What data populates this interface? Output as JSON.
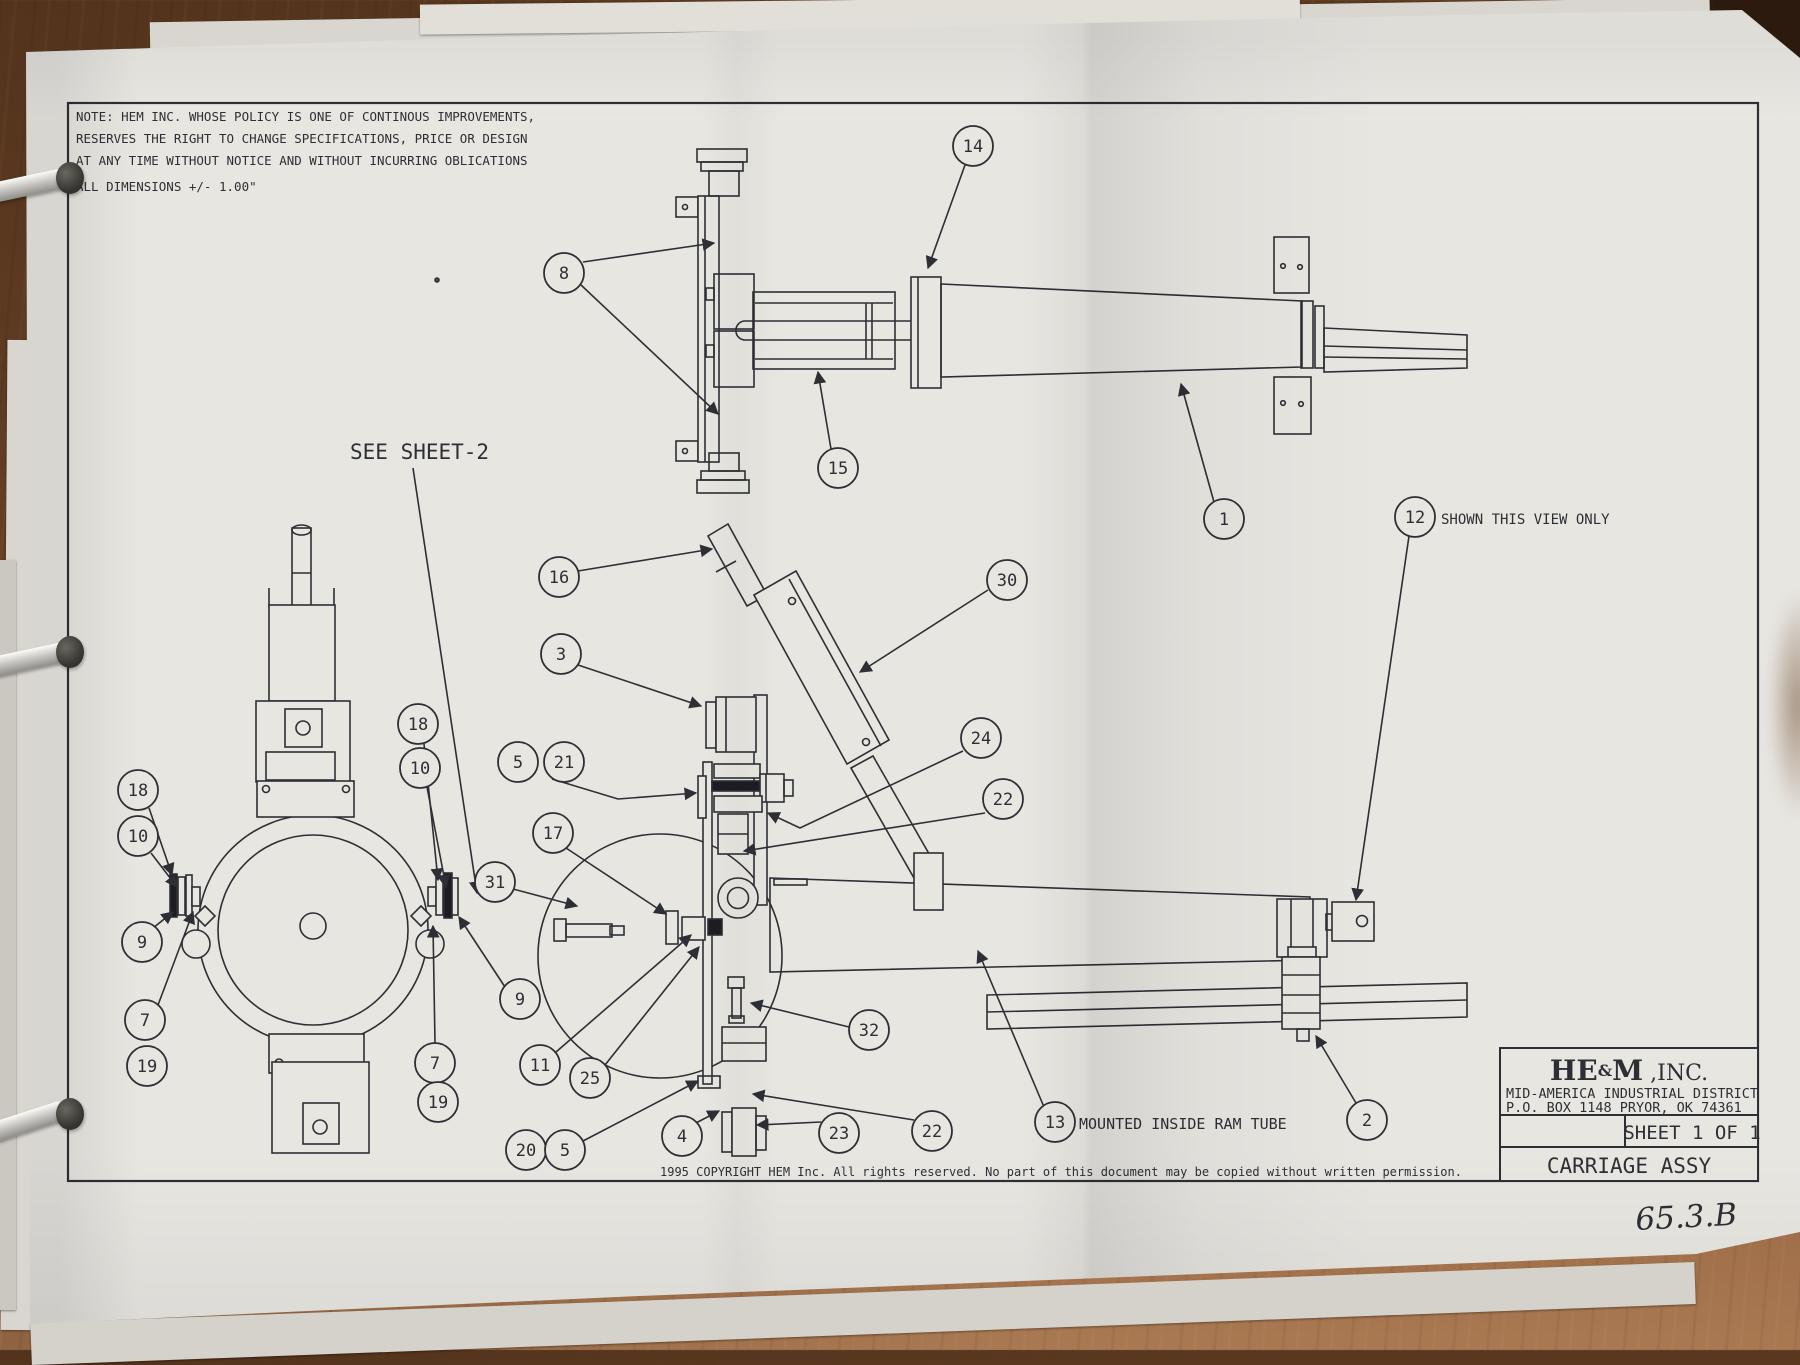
{
  "note": {
    "lines": [
      "NOTE: HEM INC. WHOSE POLICY IS ONE OF CONTINOUS IMPROVEMENTS,",
      "RESERVES THE RIGHT TO CHANGE SPECIFICATIONS, PRICE OR DESIGN",
      "AT ANY TIME WITHOUT NOTICE AND WITHOUT INCURRING OBLICATIONS",
      "ALL DIMENSIONS +/- 1.00\""
    ]
  },
  "labels": {
    "see_sheet": "SEE SHEET-2",
    "shown_view": "SHOWN THIS VIEW ONLY",
    "mounted": "MOUNTED INSIDE RAM TUBE"
  },
  "copyright": "1995 COPYRIGHT   HEM Inc.   All rights reserved.   No part of this document may be copied without written permission.",
  "title_block": {
    "logo_he": "HE",
    "logo_amp": "&",
    "logo_m": "M",
    "logo_suffix": " ,INC.",
    "address1": "MID-AMERICA INDUSTRIAL DISTRICT",
    "address2": "P.O. BOX 1148    PRYOR, OK   74361",
    "sheet": "SHEET 1 OF 1",
    "title": "CARRIAGE ASSY"
  },
  "handwritten": "65.3.B",
  "colors": {
    "paper": "#e8e6e1",
    "ink": "#2e2f35",
    "wood_dark": "#5a3820",
    "wood_light": "#a97952"
  },
  "balloons": [
    {
      "id": "8",
      "label": "8",
      "x": 564,
      "y": 273,
      "leaders": [
        [
          [
            583,
            262
          ],
          [
            714,
            243
          ]
        ],
        [
          [
            581,
            285
          ],
          [
            718,
            414
          ]
        ]
      ]
    },
    {
      "id": "14",
      "label": "14",
      "x": 973,
      "y": 146,
      "leaders": [
        [
          [
            965,
            165
          ],
          [
            928,
            268
          ]
        ]
      ]
    },
    {
      "id": "15",
      "label": "15",
      "x": 838,
      "y": 468,
      "leaders": [
        [
          [
            831,
            449
          ],
          [
            818,
            372
          ]
        ]
      ]
    },
    {
      "id": "1",
      "label": "1",
      "x": 1224,
      "y": 519,
      "leaders": [
        [
          [
            1214,
            502
          ],
          [
            1181,
            384
          ]
        ]
      ]
    },
    {
      "id": "12",
      "label": "12",
      "x": 1415,
      "y": 517,
      "leaders": [
        [
          [
            1409,
            536
          ],
          [
            1356,
            900
          ]
        ]
      ]
    },
    {
      "id": "16",
      "label": "16",
      "x": 559,
      "y": 577,
      "leaders": [
        [
          [
            578,
            571
          ],
          [
            712,
            549
          ]
        ]
      ]
    },
    {
      "id": "30",
      "label": "30",
      "x": 1007,
      "y": 580,
      "leaders": [
        [
          [
            988,
            590
          ],
          [
            860,
            672
          ]
        ]
      ]
    },
    {
      "id": "3",
      "label": "3",
      "x": 561,
      "y": 654,
      "leaders": [
        [
          [
            578,
            665
          ],
          [
            701,
            706
          ]
        ]
      ]
    },
    {
      "id": "18m",
      "label": "18",
      "x": 418,
      "y": 724,
      "leaders": [
        [
          [
            424,
            744
          ],
          [
            438,
            880
          ]
        ]
      ]
    },
    {
      "id": "10m",
      "label": "10",
      "x": 420,
      "y": 768,
      "leaders": [
        [
          [
            427,
            787
          ],
          [
            446,
            887
          ]
        ]
      ]
    },
    {
      "id": "5a",
      "label": "5",
      "x": 518,
      "y": 762,
      "leaders": []
    },
    {
      "id": "21",
      "label": "21",
      "x": 564,
      "y": 762,
      "leaders": [
        [
          [
            552,
            779
          ],
          [
            618,
            799
          ],
          [
            696,
            793
          ]
        ]
      ]
    },
    {
      "id": "24",
      "label": "24",
      "x": 981,
      "y": 738,
      "leaders": [
        [
          [
            963,
            751
          ],
          [
            800,
            828
          ],
          [
            768,
            813
          ]
        ]
      ]
    },
    {
      "id": "22a",
      "label": "22",
      "x": 1003,
      "y": 799,
      "leaders": [
        [
          [
            985,
            813
          ],
          [
            744,
            851
          ]
        ]
      ]
    },
    {
      "id": "17",
      "label": "17",
      "x": 553,
      "y": 833,
      "leaders": [
        [
          [
            566,
            848
          ],
          [
            666,
            914
          ]
        ]
      ]
    },
    {
      "id": "31",
      "label": "31",
      "x": 495,
      "y": 882,
      "leaders": [
        [
          [
            513,
            889
          ],
          [
            577,
            906
          ]
        ]
      ]
    },
    {
      "id": "18L",
      "label": "18",
      "x": 138,
      "y": 790,
      "leaders": [
        [
          [
            149,
            808
          ],
          [
            172,
            875
          ]
        ]
      ]
    },
    {
      "id": "10L",
      "label": "10",
      "x": 138,
      "y": 836,
      "leaders": [
        [
          [
            151,
            853
          ],
          [
            177,
            887
          ]
        ]
      ]
    },
    {
      "id": "9L",
      "label": "9",
      "x": 142,
      "y": 942,
      "leaders": [
        [
          [
            153,
            928
          ],
          [
            173,
            912
          ]
        ]
      ]
    },
    {
      "id": "7L",
      "label": "7",
      "x": 145,
      "y": 1020,
      "leaders": [
        [
          [
            158,
            1005
          ],
          [
            193,
            912
          ]
        ]
      ]
    },
    {
      "id": "19L",
      "label": "19",
      "x": 147,
      "y": 1066,
      "leaders": []
    },
    {
      "id": "9R",
      "label": "9",
      "x": 520,
      "y": 999,
      "leaders": [
        [
          [
            505,
            987
          ],
          [
            459,
            917
          ]
        ]
      ]
    },
    {
      "id": "7R",
      "label": "7",
      "x": 435,
      "y": 1063,
      "leaders": [
        [
          [
            435,
            1043
          ],
          [
            433,
            926
          ]
        ]
      ]
    },
    {
      "id": "19R",
      "label": "19",
      "x": 438,
      "y": 1102,
      "leaders": []
    },
    {
      "id": "11",
      "label": "11",
      "x": 540,
      "y": 1065,
      "leaders": [
        [
          [
            556,
            1052
          ],
          [
            691,
            935
          ]
        ]
      ]
    },
    {
      "id": "25",
      "label": "25",
      "x": 590,
      "y": 1078,
      "leaders": [
        [
          [
            605,
            1065
          ],
          [
            699,
            947
          ]
        ]
      ]
    },
    {
      "id": "32",
      "label": "32",
      "x": 869,
      "y": 1030,
      "leaders": [
        [
          [
            849,
            1027
          ],
          [
            751,
            1003
          ]
        ]
      ]
    },
    {
      "id": "20",
      "label": "20",
      "x": 526,
      "y": 1150,
      "leaders": []
    },
    {
      "id": "5b",
      "label": "5",
      "x": 565,
      "y": 1150,
      "leaders": [
        [
          [
            583,
            1141
          ],
          [
            698,
            1081
          ]
        ]
      ]
    },
    {
      "id": "4",
      "label": "4",
      "x": 682,
      "y": 1136,
      "leaders": [
        [
          [
            694,
            1124
          ],
          [
            719,
            1111
          ]
        ]
      ]
    },
    {
      "id": "23",
      "label": "23",
      "x": 839,
      "y": 1133,
      "leaders": [
        [
          [
            821,
            1122
          ],
          [
            757,
            1125
          ]
        ]
      ]
    },
    {
      "id": "22b",
      "label": "22",
      "x": 932,
      "y": 1131,
      "leaders": [
        [
          [
            914,
            1120
          ],
          [
            753,
            1094
          ]
        ]
      ]
    },
    {
      "id": "13",
      "label": "13",
      "x": 1055,
      "y": 1122,
      "leaders": [
        [
          [
            1044,
            1107
          ],
          [
            978,
            951
          ]
        ]
      ]
    },
    {
      "id": "2",
      "label": "2",
      "x": 1367,
      "y": 1120,
      "leaders": [
        [
          [
            1356,
            1103
          ],
          [
            1316,
            1036
          ]
        ]
      ]
    }
  ]
}
